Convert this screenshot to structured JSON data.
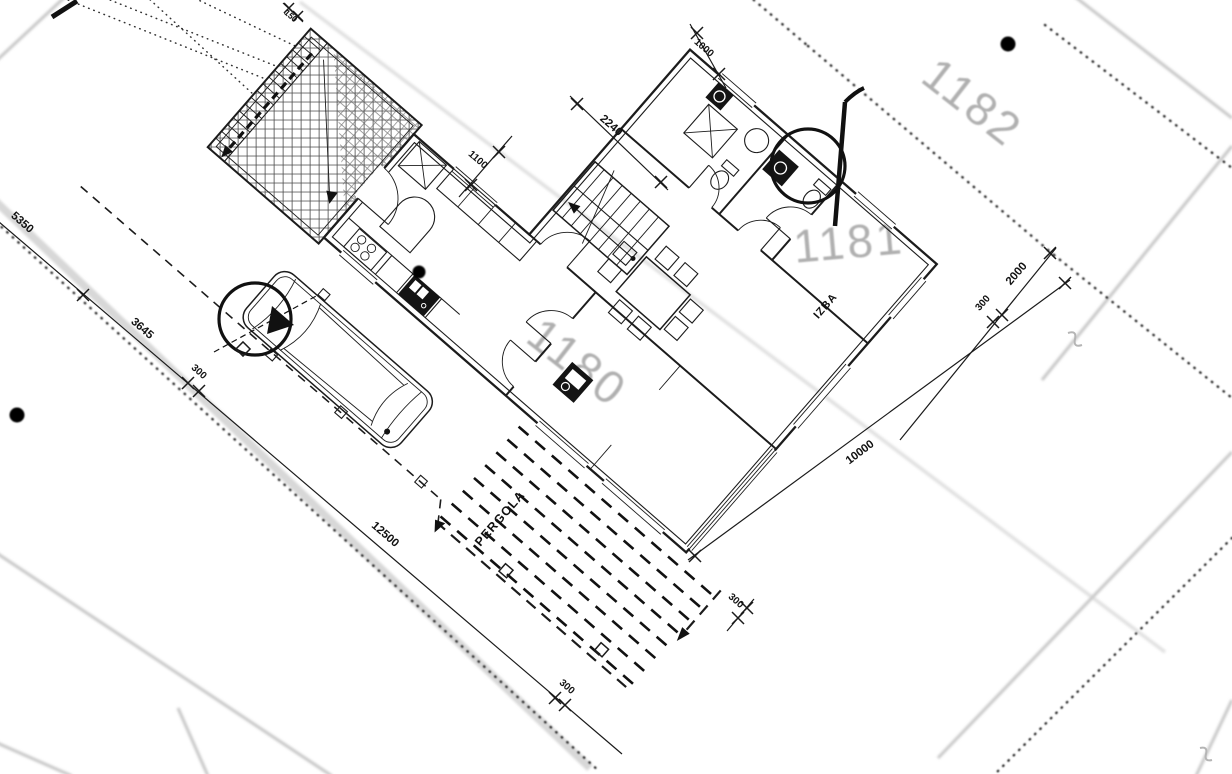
{
  "parcels": {
    "n1182": "1182",
    "n1181": "1181",
    "n1180": "1180"
  },
  "rooms": {
    "izba": "IZBA",
    "pergola": "PERGOLA"
  },
  "dims": {
    "left1": "5350",
    "left2": "3645",
    "left3": "300",
    "left4": "12500",
    "left5": "300",
    "top1": "1000",
    "top2": "2240",
    "top3": "1100",
    "top4": "150",
    "right1": "2000",
    "right2": "300",
    "east1": "10000",
    "pergola_off": "300"
  },
  "colors": {
    "line": "#1c1c1c",
    "parcel_text": "#9c9c9c",
    "boundary_gray": "#c6c6c6"
  }
}
